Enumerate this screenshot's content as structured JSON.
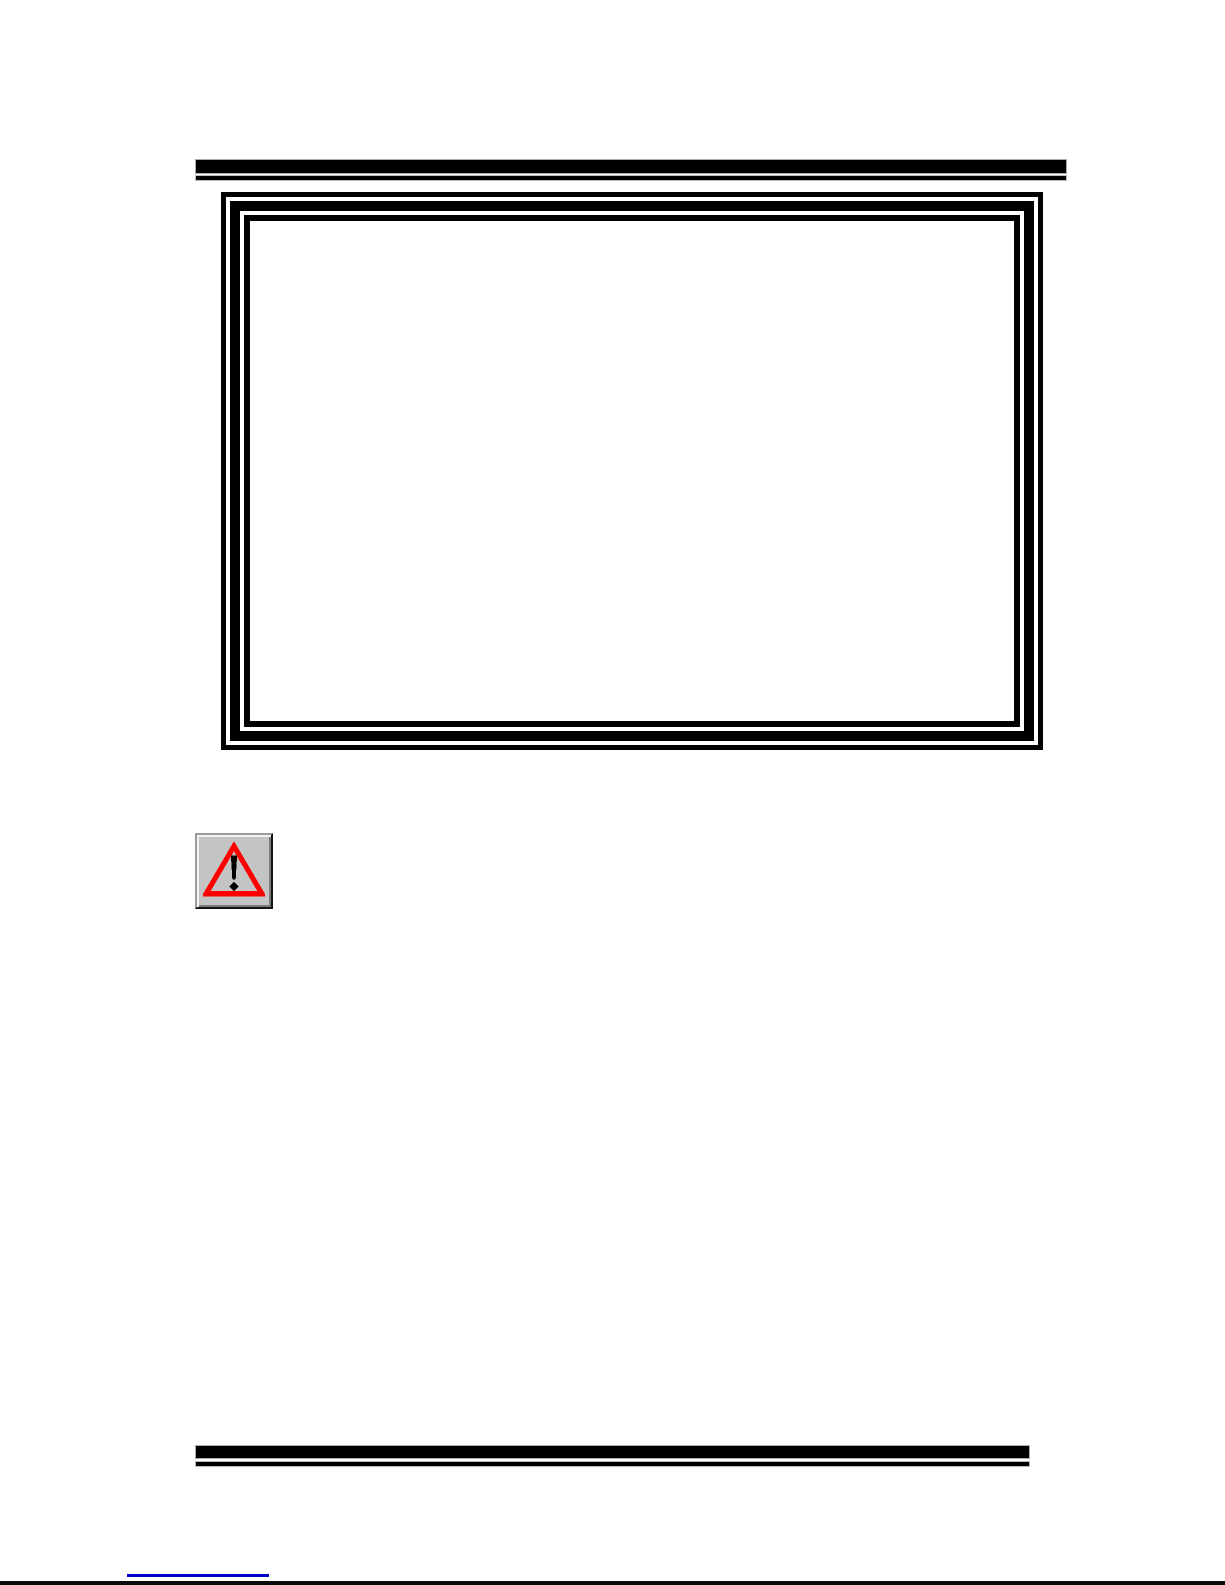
{
  "page": {
    "type": "document-page",
    "visible_text": ""
  },
  "figure_box": {
    "content": "",
    "style": "triple-line-border"
  },
  "warning_button": {
    "icon": "warning-triangle-icon",
    "style": "raised-3d-button"
  },
  "footer": {
    "link_text_visible": "",
    "has_link_underline": true
  },
  "colors": {
    "page-bg": "#ffffff",
    "rule": "#000000",
    "frame": "#000000",
    "btnface": "#c4c4c4",
    "warn": "#ff0000",
    "excl": "#000000",
    "link": "#0000cc",
    "cutoff": "#0a0a0a"
  }
}
